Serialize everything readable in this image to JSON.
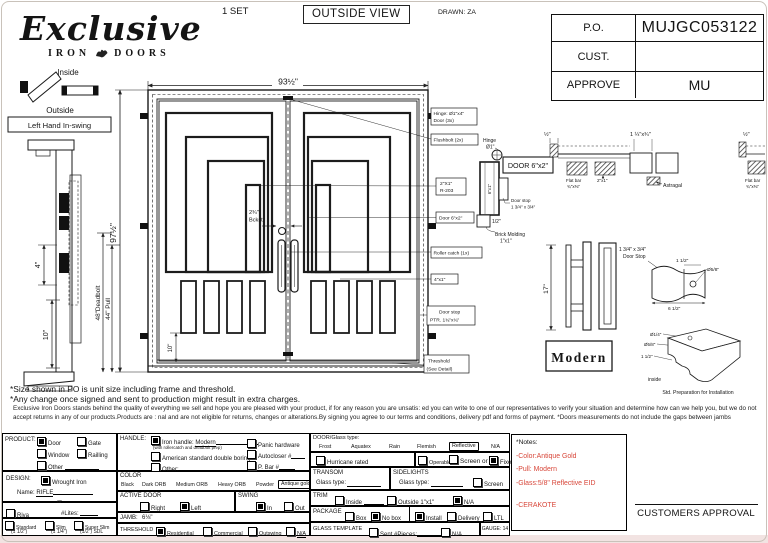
{
  "colors": {
    "red_note": "#d8473a",
    "ink": "#141414"
  },
  "header": {
    "set": "1 SET",
    "view": "OUTSIDE VIEW",
    "drawn": "DRAWN: ZA",
    "logo_script": "Exclusive",
    "logo_iron": "IRON",
    "logo_doors": "DOORS"
  },
  "po": {
    "po_label": "P.O.",
    "po_value": "MUJGC053122",
    "cust_label": "CUST.",
    "cust_value": "",
    "approve_label": "APPROVE",
    "approve_value": "MU"
  },
  "swing_diag": {
    "inside": "Inside",
    "outside": "Outside",
    "label": "Left Hand In-swing"
  },
  "side_section": {
    "dim4": "4\"",
    "dim10": "10\""
  },
  "door": {
    "width": "93½\"",
    "height": "97½\"",
    "deadbolt": "48\"Deadbolt",
    "pull": "44\" Pull",
    "backset1": "2¾\"",
    "backset2": "Bckst.",
    "dim10": "10\""
  },
  "callouts": {
    "hinge1": "Hinge: Ø1\"x4\"",
    "hinge2": "Door (3x)",
    "flushbolt": "Flushbolt (2x)",
    "bar1": "2\"X1\"",
    "bar2": "R-203",
    "door62": "Door 6\"x2\"",
    "roller": "Roller catch  (1x)",
    "b41": "4\"x1\"",
    "stop1": "Door stop",
    "stop2": "PTR. 1¾\"x¾\"",
    "th1": "Threshold",
    "th2": "(See Detail)"
  },
  "jamb_detail": {
    "hinge1": "Hinge",
    "hinge2": "Ø1\"",
    "door_label": "DOOR 6\"x2\"",
    "profile": "6\"x1\"",
    "stop1": "Door stop",
    "stop2": "1 3/4\" x 3/4\"",
    "half": "1/2\"",
    "brick1": "Brick Molding",
    "brick2": "1\"x1\""
  },
  "head_detail": {
    "half_l": "½\"",
    "flat1a": "Flat bar",
    "flat1b": "¾\"x⅜\"",
    "b21": "2\"x1\"",
    "astragal_dim": "1 ¼\"x¾\"",
    "astragal": "Astragal",
    "half_r": "½\"",
    "flat2a": "Flat bar",
    "flat2b": "¾\"x⅜\""
  },
  "pull_detail": {
    "dim": "17\"",
    "name": "Modern"
  },
  "stop_detail": {
    "l1": "1 3/4\" x 3/4\"",
    "l2": "Door Stop",
    "d1": "1 1/2\"",
    "d2": "Ø5/8\"",
    "d3": "6 1/2\""
  },
  "prep_detail": {
    "d1": "Ø1/4\"",
    "d2": "Ø5/8\"",
    "d3": "1 1/2\"",
    "outside": "outside",
    "inside": "inside",
    "caption": "Std. Preparation for Installation"
  },
  "notes": {
    "line1": "*Size shown in PO is unit size including frame and threshold.",
    "line2": "*Any change once signed and sent to production might result in extra charges.",
    "fine_print": "Exclusive Iron Doors stands behind the quality of everything we sell and hope you are pleased with your product, if for any reason you are unsatis: ed you can write to one of our representatives to verify your situation and determine how can we help you, but we do not accept returns in any of our products.Products are : nal and are not eligible for returns, changes or alterations.By signing you agree to our terms and conditions, delivery pdf and forms of payment. *Doors measurements do not include the gaps between jambs"
  },
  "form": {
    "product": {
      "label": "PRODUCT:",
      "options": [
        {
          "label": "Door",
          "checked": true
        },
        {
          "label": "Gate",
          "checked": false
        },
        {
          "label": "Window",
          "checked": false
        },
        {
          "label": "Railling",
          "checked": false
        },
        {
          "label": "Other",
          "checked": false
        }
      ]
    },
    "design": {
      "label": "DESIGN:",
      "wrought_label": "Wrought Iron",
      "wrought_checked": true,
      "name_label": "Name:",
      "name_value": "RIFLE",
      "or_label": "or",
      "riva_label": "Riva",
      "riva_checked": false,
      "lites_label": "#Lites:",
      "profiles": [
        {
          "label": "Standard",
          "sub": "(1 1/2\")",
          "checked": false
        },
        {
          "label": "Slim",
          "sub": "(1 1/4\")",
          "checked": false
        },
        {
          "label": "Super Slim",
          "sub": "(1/2\") SDL",
          "checked": false
        }
      ]
    },
    "handle": {
      "label": "HANDLE:",
      "iron_label": "Iron handle:",
      "iron_value": "Modern",
      "iron_sub": "(with rollercatch and deadbolt prep)",
      "iron_checked": true,
      "american_label": "American standard double boring",
      "american_checked": false,
      "other_label": "Other:",
      "other_checked": false,
      "panic_label": "Panic hardware",
      "panic_checked": false,
      "autocloser_label": "Autocloser #",
      "autocloser_checked": false,
      "pbar_label": "P. Bar #",
      "pbar_checked": false
    },
    "color": {
      "label": "COLOR",
      "options": [
        "Black",
        "Dark ORB",
        "Medium ORB",
        "Heavy ORB",
        "Powder"
      ],
      "selected": "Antique gold"
    },
    "active": {
      "label": "ACTIVE DOOR",
      "right_label": "Right",
      "right_checked": false,
      "left_label": "Left",
      "left_checked": true
    },
    "swing": {
      "label": "SWING",
      "in_label": "In",
      "in_checked": true,
      "out_label": "Out",
      "out_checked": false
    },
    "jamb": {
      "label": "JAMB:",
      "value": "6⅛\""
    },
    "threshold": {
      "label": "THRESHOLD",
      "options": [
        {
          "label": "Residential",
          "checked": true
        },
        {
          "label": "Commercial",
          "checked": false
        },
        {
          "label": "Outswing",
          "checked": false
        },
        {
          "label": "N/A",
          "checked": false
        }
      ]
    },
    "glass": {
      "label": "DOOR/Glass type:",
      "options": [
        "Frost",
        "Aquatex",
        "Rain",
        "Flemish"
      ],
      "selected": "Reflective",
      "na": "N/A",
      "hurricane_label": "Hurricane rated",
      "hurricane_checked": false,
      "operable_label": "Operable",
      "operable_checked": false,
      "screen_or_label": "Screen or",
      "screen_checked": false,
      "fixed_label": "Fixed",
      "fixed_checked": true
    },
    "transom": {
      "label": "TRANSOM",
      "glass_label": "Glass type:"
    },
    "sidelights": {
      "label": "SIDELIGHTS",
      "glass_label": "Glass type:",
      "screen_label": "Screen",
      "screen_checked": false
    },
    "trim": {
      "label": "TRIM",
      "inside_label": "Inside",
      "inside_checked": false,
      "outside_label": "Outside",
      "outside_value": "1\"x1\"",
      "outside_checked": false,
      "na_label": "N/A",
      "na_checked": true
    },
    "package": {
      "label": "PACKAGE",
      "box_label": "Box",
      "box_checked": false,
      "nobox_label": "No box",
      "nobox_checked": true,
      "install_label": "Install",
      "install_checked": true,
      "delivery_label": "Delivery",
      "delivery_checked": false,
      "ltl_label": "LTL",
      "ltl_checked": false
    },
    "template": {
      "label": "GLASS TEMPLATE",
      "sent_label": "Sent #Pieces:",
      "sent_checked": false,
      "na_label": "N/A",
      "na_checked": false,
      "gauge_label": "GAUGE: 14"
    }
  },
  "footer": {
    "notes_title": "*Notes:",
    "red1": "-Color:Antique Gold",
    "red2": "-Pull: Modern",
    "red3": "-Glass:5/8\" Reflective EID",
    "red4": "-CERAKOTE",
    "approval": "CUSTOMERS APPROVAL"
  }
}
